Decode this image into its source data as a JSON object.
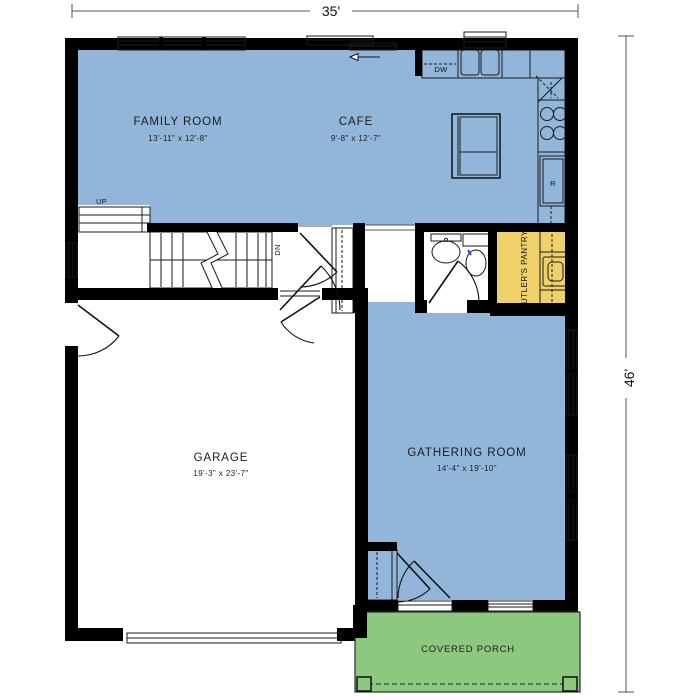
{
  "floor_plan": {
    "dimensions": {
      "width_label": "35'",
      "height_label": "46'"
    },
    "rooms": [
      {
        "id": "family-room",
        "name": "FAMILY ROOM",
        "size": "13'-11\" x 12'-8\""
      },
      {
        "id": "cafe",
        "name": "CAFE",
        "size": "9'-8\" x 12'-7\""
      },
      {
        "id": "garage",
        "name": "GARAGE",
        "size": "19'-3\" x 23'-7\""
      },
      {
        "id": "gathering-room",
        "name": "GATHERING ROOM",
        "size": "14'-4\" x 19'-10\""
      },
      {
        "id": "butlers-pantry",
        "name": "BUTLER'S PANTRY"
      },
      {
        "id": "covered-porch",
        "name": "COVERED PORCH"
      }
    ],
    "annotations": {
      "up": "UP",
      "down": "DN",
      "dishwasher": "DW",
      "refrigerator": "R"
    },
    "colors": {
      "living_area": "#92b6d9",
      "cabinet_accent": "#eed169",
      "porch": "#8cc87e",
      "wall": "#000000",
      "dimension_line": "#4a4a4a"
    }
  }
}
